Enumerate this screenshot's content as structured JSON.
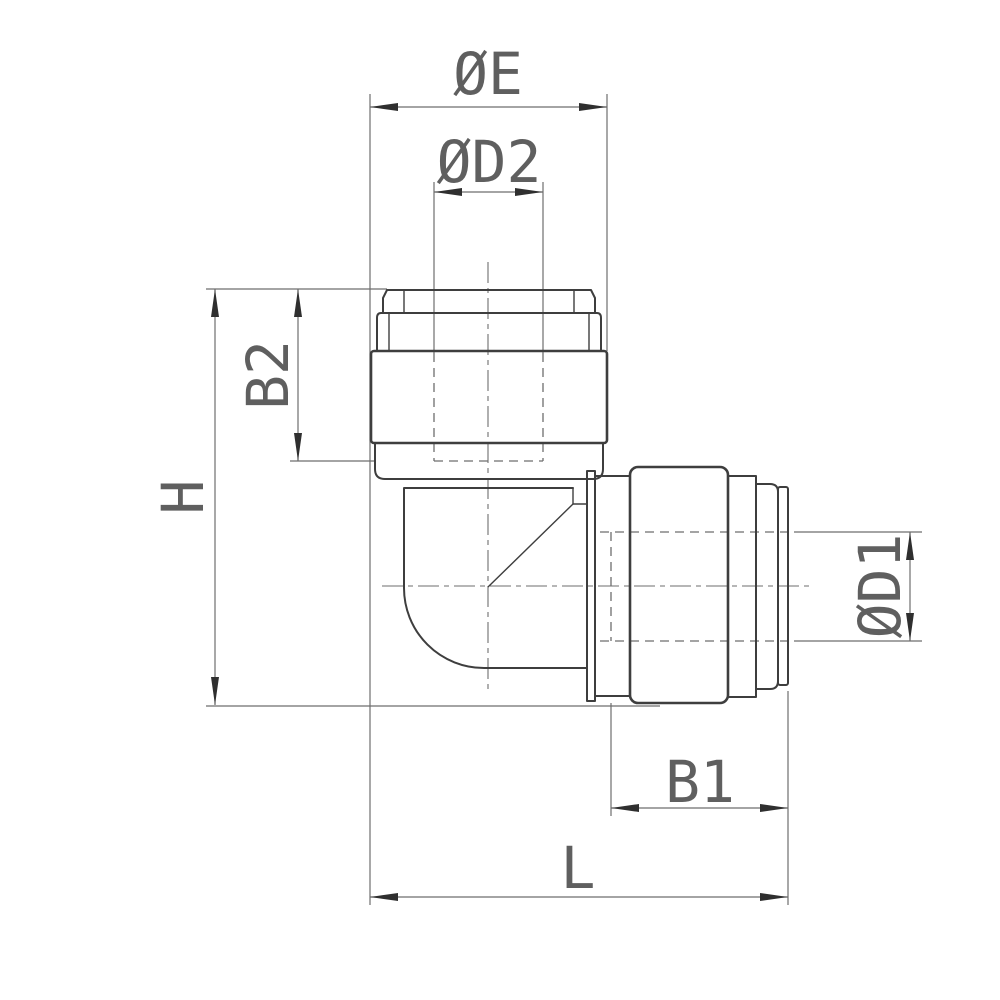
{
  "drawing": {
    "type": "technical-drawing",
    "subject": "90-degree elbow push-in tube fitting, side view with dimensions",
    "labels": {
      "oe": "ØE",
      "od2": "ØD2",
      "b2": "B2",
      "h": "H",
      "od1": "ØD1",
      "b1": "B1",
      "l": "L"
    },
    "colors": {
      "background": "#ffffff",
      "outline": "#3e3e3e",
      "thin": "#6e6e6e",
      "arrow": "#2f2f2f",
      "text": "#5f5f5f"
    }
  }
}
